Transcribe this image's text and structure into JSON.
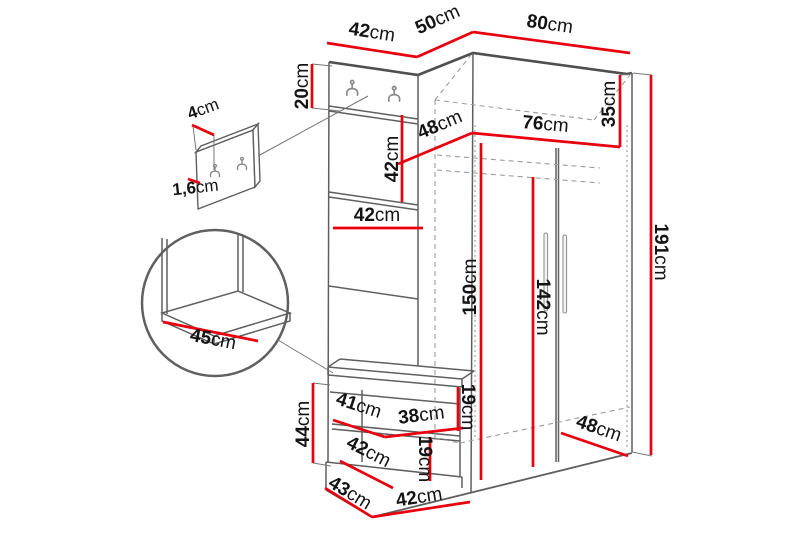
{
  "diagram": {
    "title": "hallway-furniture-dimension-diagram",
    "units": "cm",
    "colors": {
      "dimension_line": "#e8000d",
      "outline": "#5f5f5f",
      "hidden_line": "#9c9c9c",
      "text": "#141414"
    },
    "labels": {
      "top_panel_width": {
        "num": "42",
        "unit": "cm"
      },
      "top_depth": {
        "num": "50",
        "unit": "cm"
      },
      "wardrobe_width": {
        "num": "80",
        "unit": "cm"
      },
      "hook_section_height": {
        "num": "20",
        "unit": "cm"
      },
      "mirror_height": {
        "num": "42",
        "unit": "cm"
      },
      "panel_width": {
        "num": "42",
        "unit": "cm"
      },
      "top_shelf_depth": {
        "num": "48",
        "unit": "cm"
      },
      "top_shelf_width": {
        "num": "76",
        "unit": "cm"
      },
      "top_compartment_height": {
        "num": "35",
        "unit": "cm"
      },
      "interior_height": {
        "num": "150",
        "unit": "cm"
      },
      "door_height": {
        "num": "142",
        "unit": "cm"
      },
      "total_height": {
        "num": "191",
        "unit": "cm"
      },
      "seat_depth_detail": {
        "num": "45",
        "unit": "cm"
      },
      "hook_panel_depth": {
        "num": "4",
        "unit": "cm"
      },
      "hook_panel_thickness": {
        "num": "1,6",
        "unit": "cm"
      },
      "bench_height": {
        "num": "44",
        "unit": "cm"
      },
      "bench_niche_depth": {
        "num": "41",
        "unit": "cm"
      },
      "bench_niche_width": {
        "num": "38",
        "unit": "cm"
      },
      "bench_niche_height": {
        "num": "19",
        "unit": "cm"
      },
      "bench_lower_depth": {
        "num": "42",
        "unit": "cm"
      },
      "bench_lower_height": {
        "num": "19",
        "unit": "cm"
      },
      "plinth_depth": {
        "num": "43",
        "unit": "cm"
      },
      "plinth_width": {
        "num": "42",
        "unit": "cm"
      },
      "wardrobe_bottom_depth": {
        "num": "48",
        "unit": "cm"
      }
    }
  }
}
